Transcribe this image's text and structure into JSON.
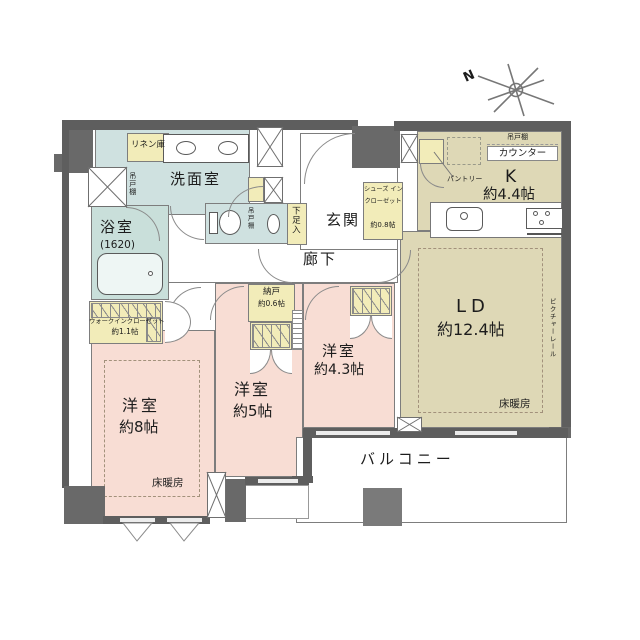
{
  "plan": {
    "compass_n": "N",
    "washroom": "洗面室",
    "linen": "リネン庫",
    "laundry_shelf": "吊戸棚",
    "bath": "浴室",
    "bath_size": "(1620)",
    "wic": "ウォークインクローゼット",
    "wic_size": "約1.1帖",
    "bedroom8": "洋室",
    "bedroom8_size": "約8帖",
    "bedroom8_heating": "床暖房",
    "bedroom5": "洋室",
    "bedroom5_size": "約5帖",
    "storage": "納戸",
    "storage_size": "約0.6帖",
    "bedroom43": "洋室",
    "bedroom43_size": "約4.3帖",
    "hallway": "廊下",
    "entrance": "玄関",
    "shoe_cabinet": "下足入",
    "shoe_closet_1": "シューズ イン",
    "shoe_closet_2": "クローゼット",
    "shoe_closet_size": "約0.8帖",
    "toilet_shelf": "吊戸棚",
    "kitchen": "K",
    "kitchen_size": "約4.4帖",
    "kitchen_counter": "カウンター",
    "kitchen_shelf": "吊戸棚",
    "pantry": "パントリー",
    "ld": "LD",
    "ld_size": "約12.4帖",
    "ld_heating": "床暖房",
    "picture_rail": "ピクチャーレール",
    "balcony": "バルコニー"
  },
  "colors": {
    "wall": "#5e5e5e",
    "pillar": "#696969",
    "bedroom_pink": "#f8ddd4",
    "living_beige": "#ded8b6",
    "wet_blue": "#cfe1e0",
    "bath_blue": "#c9dfda",
    "closet_yellow": "#f2ecb9",
    "balcony_pillar": "#7a7a7a"
  }
}
